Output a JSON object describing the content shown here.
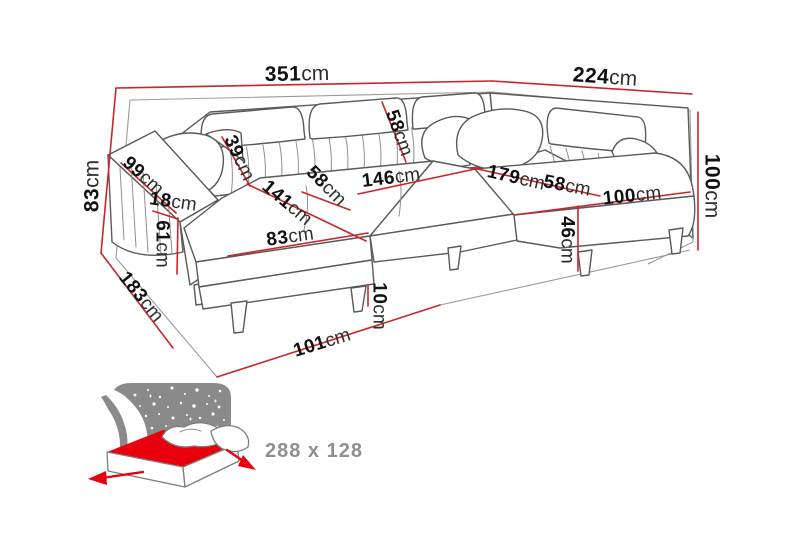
{
  "diagram": {
    "title": "corner-sofa-dimension-diagram",
    "unit": "cm",
    "dimensions": [
      {
        "name": "total-width-left",
        "value": "351",
        "unit": "cm",
        "x": 297,
        "y": 74,
        "rotate": -1,
        "size": 21
      },
      {
        "name": "total-width-right",
        "value": "224",
        "unit": "cm",
        "x": 605,
        "y": 77,
        "rotate": 4,
        "size": 21
      },
      {
        "name": "height-left",
        "value": "83",
        "unit": "cm",
        "x": 92,
        "y": 186,
        "rotate": -90,
        "size": 21
      },
      {
        "name": "arm-length",
        "value": "99",
        "unit": "cm",
        "x": 143,
        "y": 176,
        "rotate": 42,
        "size": 19
      },
      {
        "name": "arm-top-width",
        "value": "18",
        "unit": "cm",
        "x": 173,
        "y": 202,
        "rotate": 8,
        "size": 19
      },
      {
        "name": "arm-height",
        "value": "61",
        "unit": "cm",
        "x": 162,
        "y": 244,
        "rotate": 90,
        "size": 19
      },
      {
        "name": "backrest-depth",
        "value": "39",
        "unit": "cm",
        "x": 239,
        "y": 158,
        "rotate": 65,
        "size": 19
      },
      {
        "name": "chaise-length",
        "value": "141",
        "unit": "cm",
        "x": 287,
        "y": 203,
        "rotate": 40,
        "size": 19
      },
      {
        "name": "seat-depth-middle",
        "value": "58",
        "unit": "cm",
        "x": 326,
        "y": 186,
        "rotate": 45,
        "size": 19
      },
      {
        "name": "backrest-width",
        "value": "58",
        "unit": "cm",
        "x": 399,
        "y": 133,
        "rotate": 70,
        "size": 19
      },
      {
        "name": "seat-width-middle",
        "value": "146",
        "unit": "cm",
        "x": 391,
        "y": 178,
        "rotate": -7,
        "size": 19
      },
      {
        "name": "chaise-width",
        "value": "83",
        "unit": "cm",
        "x": 290,
        "y": 237,
        "rotate": -8,
        "size": 19
      },
      {
        "name": "seat-length-right",
        "value": "179",
        "unit": "cm",
        "x": 516,
        "y": 178,
        "rotate": 13,
        "size": 19
      },
      {
        "name": "seat-depth-right",
        "value": "58",
        "unit": "cm",
        "x": 567,
        "y": 186,
        "rotate": 11,
        "size": 19
      },
      {
        "name": "chaise-right-width",
        "value": "100",
        "unit": "cm",
        "x": 632,
        "y": 196,
        "rotate": -6,
        "size": 19
      },
      {
        "name": "seat-height",
        "value": "46",
        "unit": "cm",
        "x": 567,
        "y": 240,
        "rotate": 90,
        "size": 19
      },
      {
        "name": "height-right",
        "value": "100",
        "unit": "cm",
        "x": 712,
        "y": 186,
        "rotate": 90,
        "size": 21
      },
      {
        "name": "leg-height",
        "value": "10",
        "unit": "cm",
        "x": 379,
        "y": 306,
        "rotate": 90,
        "size": 19
      },
      {
        "name": "floor-front",
        "value": "101",
        "unit": "cm",
        "x": 322,
        "y": 343,
        "rotate": -17,
        "size": 19
      },
      {
        "name": "floor-side-left",
        "value": "183",
        "unit": "cm",
        "x": 141,
        "y": 297,
        "rotate": 51,
        "size": 19
      }
    ],
    "bed_icon": {
      "label": "288 x 128"
    },
    "colors": {
      "dimension_line": "#c8262c",
      "outline": "#5a5a5a",
      "label_number": "#111111",
      "label_unit": "#2e2e2e",
      "icon_gray": "#8a8a8a",
      "icon_text": "#8f8f8f",
      "mattress_red": "#e8000d"
    }
  }
}
